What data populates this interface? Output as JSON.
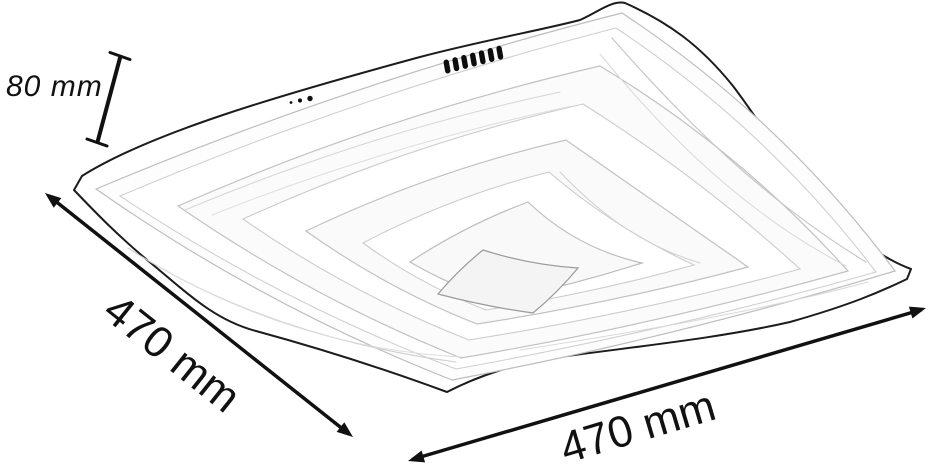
{
  "diagram": {
    "subject": "square-wave-ceiling-lamp",
    "view": "perspective product illustration with dimension arrows",
    "dimension_labels": {
      "height": "80 mm",
      "side_width": "470 mm",
      "front_width": "470 mm"
    }
  },
  "illustration": {
    "connector_pin_count": 7,
    "mounting_dot_count": 3
  },
  "colors": {
    "outline": "#1c1c1c",
    "annotation": "#111111",
    "inner_line": "#c4c4c4",
    "background": "#ffffff"
  }
}
